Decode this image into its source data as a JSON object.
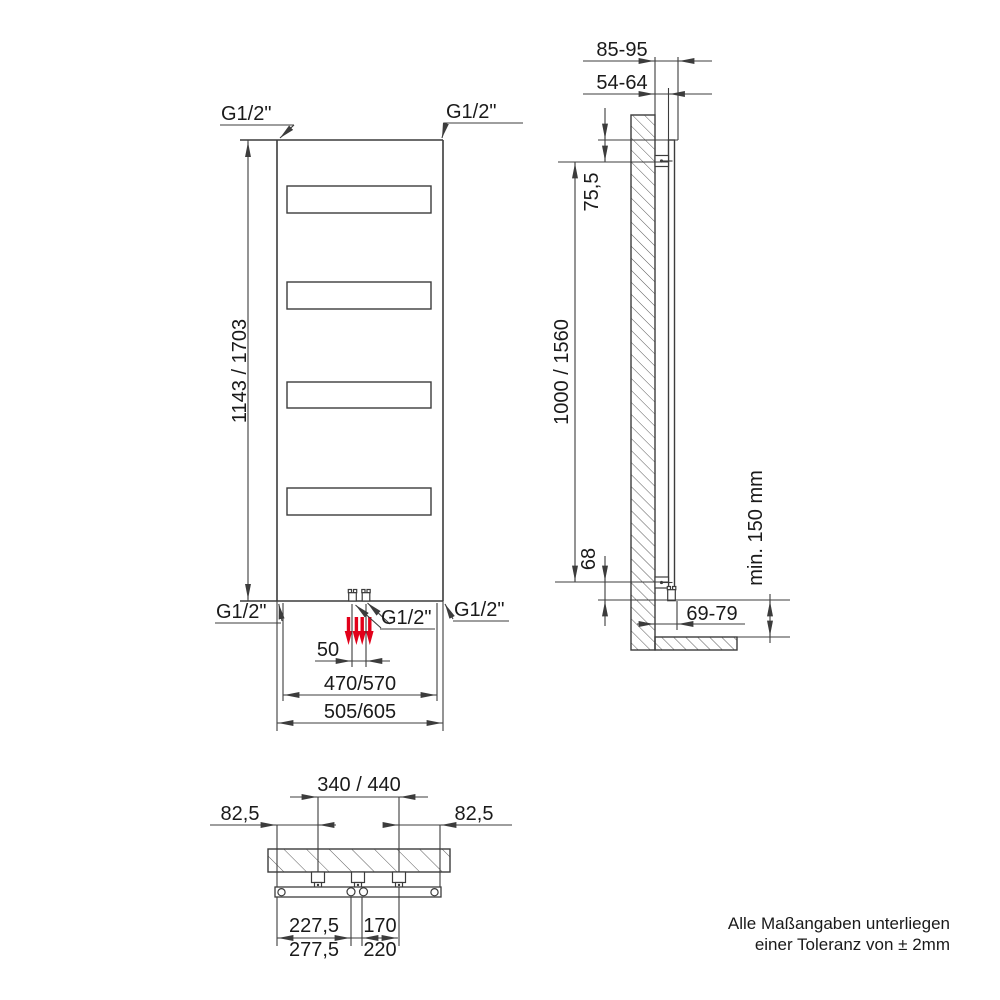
{
  "drawing": {
    "front_view": {
      "dim_height": "1143 / 1703",
      "conn_top_left": "G1/2\"",
      "conn_top_right": "G1/2\"",
      "conn_bottom_left": "G1/2\"",
      "conn_bottom_right": "G1/2\"",
      "conn_bottom_center": "G1/2\"",
      "dim_conn_spacing": "50",
      "dim_inner_width": "470/570",
      "dim_outer_width": "505/605"
    },
    "side_view": {
      "dim_depth_total": "85-95",
      "dim_depth_wall": "54-64",
      "dim_top_offset": "75,5",
      "dim_bracket_span": "1000 / 1560",
      "dim_bottom_offset": "68",
      "dim_conn_wall": "69-79",
      "dim_floor_clearance": "min. 150 mm"
    },
    "bottom_view": {
      "dim_bracket_span": "340 / 440",
      "dim_edge_left": "82,5",
      "dim_edge_right": "82,5",
      "dim_conn_left_small": "227,5",
      "dim_conn_left_large": "277,5",
      "dim_bracket_half_small": "170",
      "dim_bracket_half_large": "220"
    },
    "note": {
      "line1": "Alle Maßangaben unterliegen",
      "line2": "einer Toleranz von ± 2mm"
    },
    "colors": {
      "line": "#3c3c3c",
      "text": "#1a1a1a",
      "flow_arrow_red": "#e2001a"
    }
  }
}
